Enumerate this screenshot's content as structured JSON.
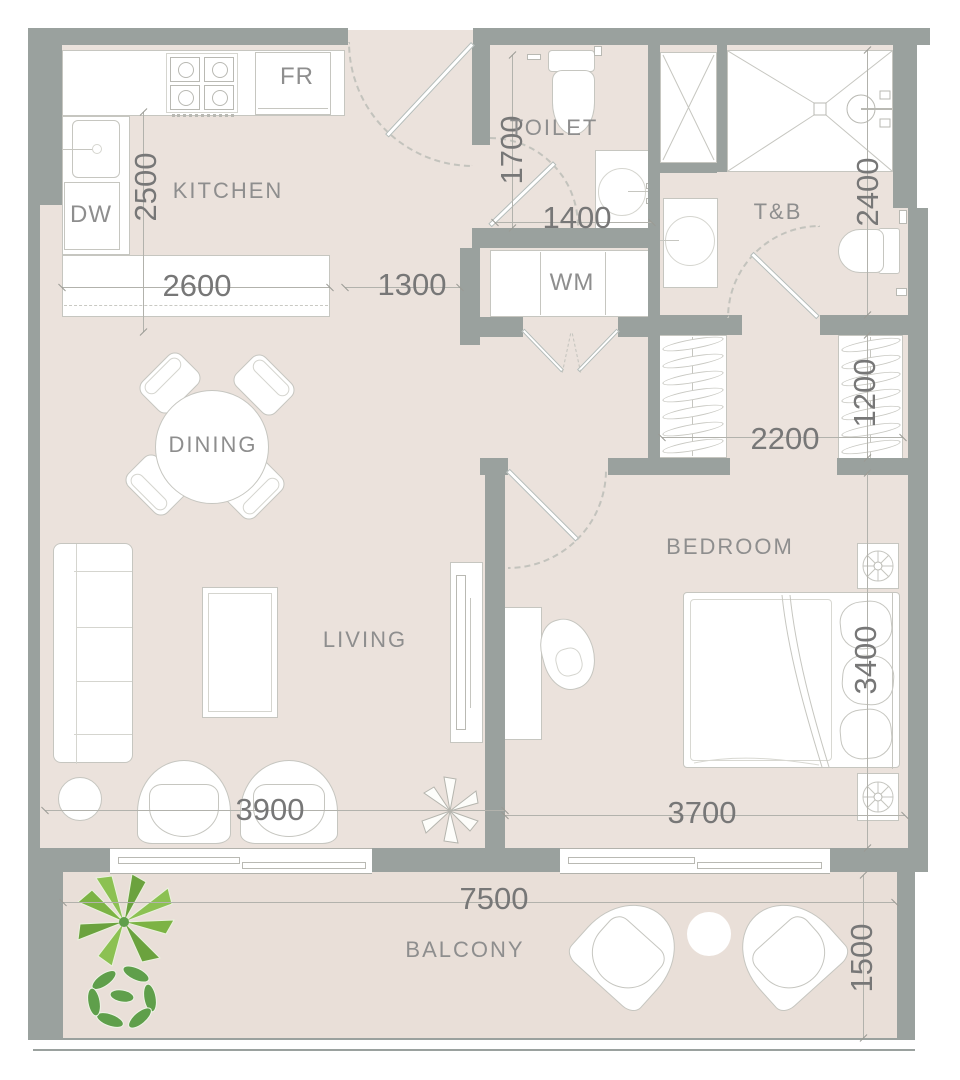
{
  "rooms": {
    "kitchen": "KITCHEN",
    "toilet": "TOILET",
    "tb": "T&B",
    "dining": "DINING",
    "living": "LIVING",
    "bedroom": "BEDROOM",
    "balcony": "BALCONY"
  },
  "appliances": {
    "fridge": "FR",
    "dishwasher": "DW",
    "washer": "WM"
  },
  "dims": {
    "kitchen_depth": "2500",
    "island_length": "2600",
    "entry_passage": "1300",
    "toilet_length": "1700",
    "toilet_width": "1400",
    "tb_length": "2400",
    "closet_width": "2200",
    "closet_depth": "1200",
    "bedroom_length": "3400",
    "bedroom_width": "3700",
    "living_width": "3900",
    "balcony_width": "7500",
    "balcony_depth": "1500"
  },
  "colors": {
    "wall": "#9aa19e",
    "floor": "#ebe2dc",
    "balcony_floor": "#e9dfd8",
    "furniture_line": "#c6c6c0",
    "dimension_text": "#777777",
    "room_label": "#8e8e8e",
    "plant_green_light": "#8cc152",
    "plant_green_dark": "#5f9f4b"
  }
}
